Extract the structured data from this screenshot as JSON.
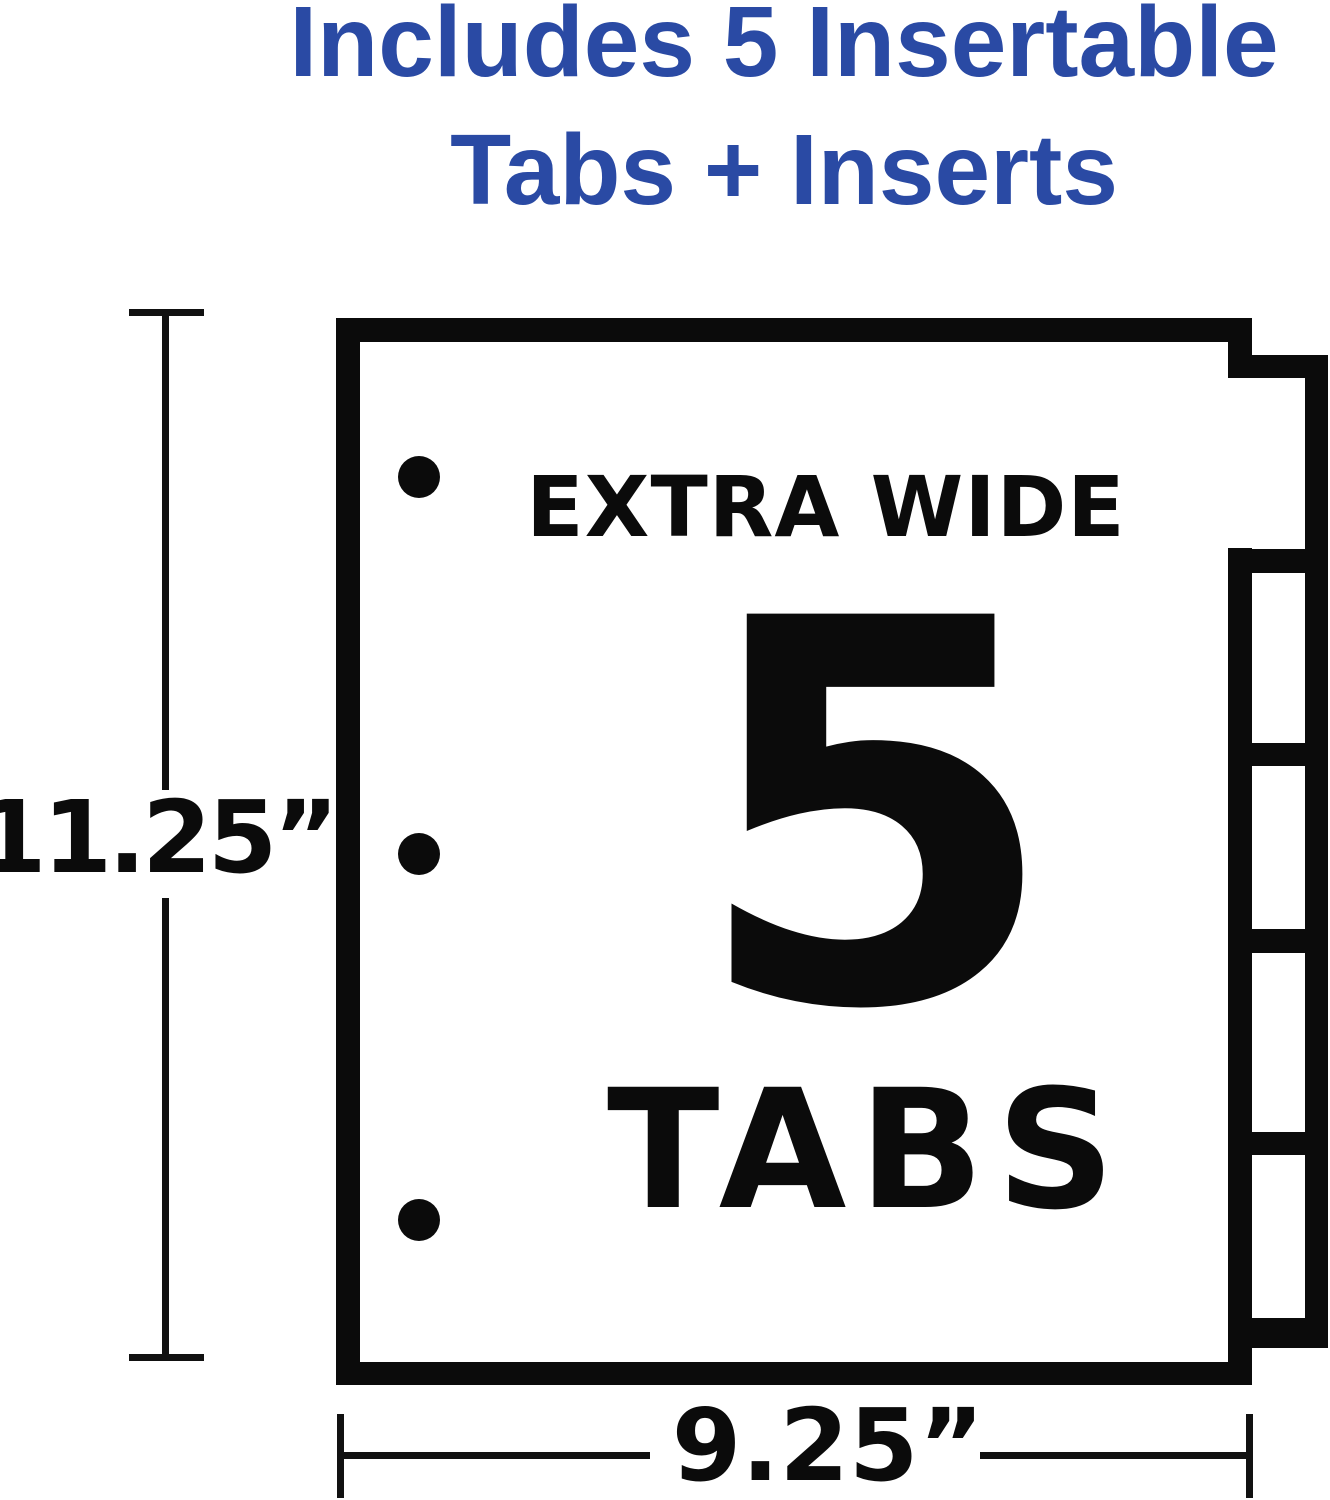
{
  "colors": {
    "accent_blue": "#2A4AA4",
    "ink": "#0B0B0B"
  },
  "title": {
    "line1": "Includes 5 Insertable",
    "line2": "Tabs + Inserts"
  },
  "sheet": {
    "label_top": "EXTRA WIDE",
    "tab_count_number": "5",
    "label_bottom": "TABS",
    "tabs_total": 5,
    "binder_holes": 3
  },
  "dimensions": {
    "height_label": "11.25”",
    "width_label": "9.25”"
  }
}
